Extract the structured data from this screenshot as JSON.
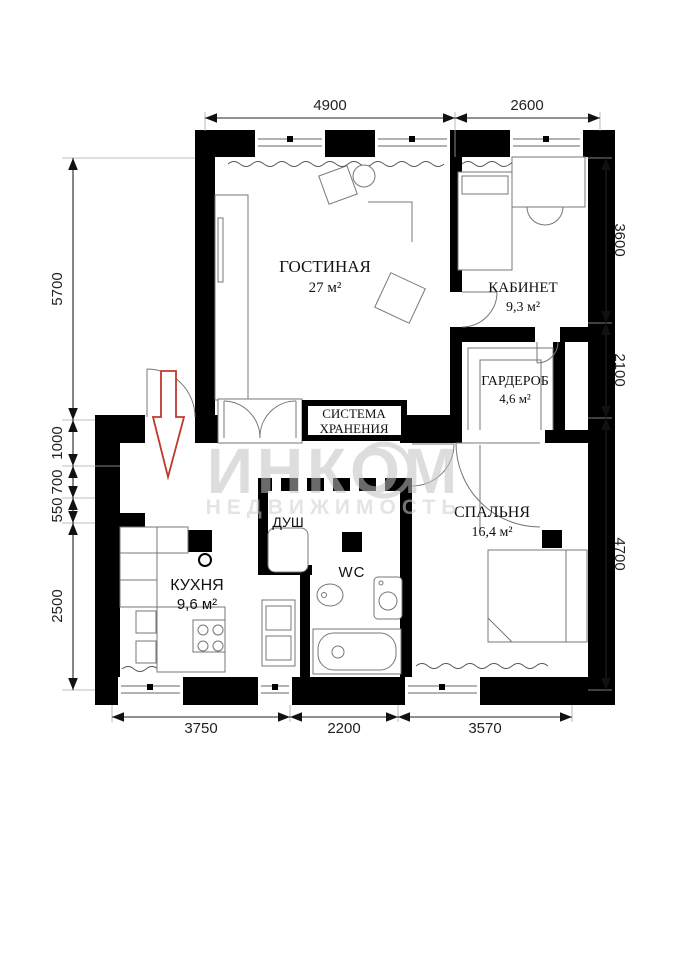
{
  "watermark": {
    "brand": "ИНКОМ",
    "subtitle": "НЕДВИЖИМОСТЬ"
  },
  "rooms": {
    "living": {
      "name": "ГОСТИНАЯ",
      "area": "27 м²"
    },
    "office": {
      "name": "КАБИНЕТ",
      "area": "9,3 м²"
    },
    "wardrobe": {
      "name": "ГАРДЕРОБ",
      "area": "4,6 м²"
    },
    "bedroom": {
      "name": "СПАЛЬНЯ",
      "area": "16,4 м²"
    },
    "kitchen": {
      "name": "КУХНЯ",
      "area": "9,6 м²"
    },
    "shower": {
      "name": "ДУШ"
    },
    "wc": {
      "name": "WC"
    },
    "storage": {
      "line1": "СИСТЕМА",
      "line2": "ХРАНЕНИЯ"
    }
  },
  "dimensions": {
    "top": [
      "4900",
      "2600"
    ],
    "left": [
      "5700",
      "1000",
      "700",
      "550",
      "2500"
    ],
    "right": [
      "3600",
      "2100",
      "4700"
    ],
    "bottom": [
      "3750",
      "2200",
      "3570"
    ]
  },
  "colors": {
    "wall": "#000000",
    "entry_arrow": "#c0392b",
    "watermark_gray": "#c2c2c2",
    "dimension_text": "#222222"
  }
}
